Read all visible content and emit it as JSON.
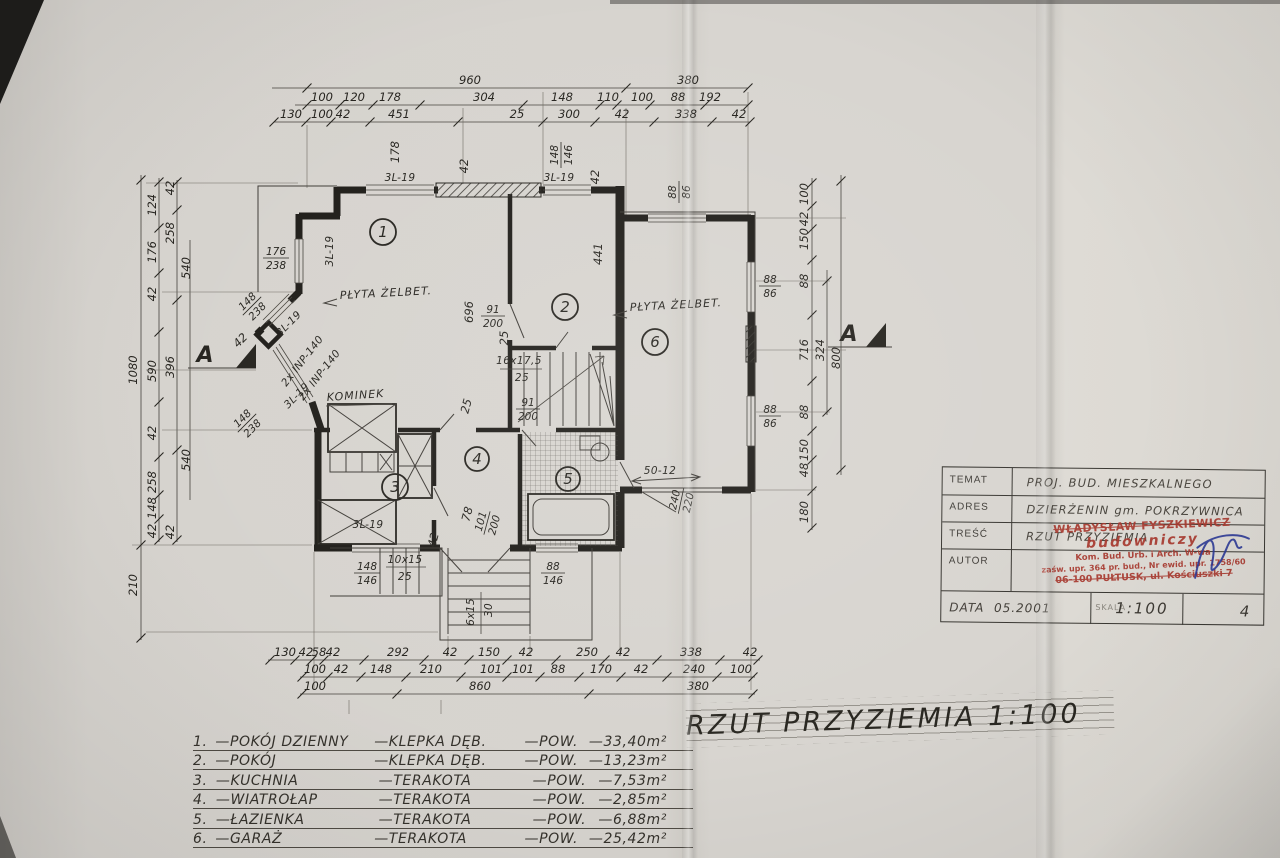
{
  "legend": {
    "dash": "—",
    "pow": "POW.",
    "rows": [
      {
        "no": "1.",
        "name": "POKÓJ DZIENNY",
        "material": "KLEPKA DĘB.",
        "area": "33,40m²"
      },
      {
        "no": "2.",
        "name": "POKÓJ",
        "material": "KLEPKA DĘB.",
        "area": "13,23m²"
      },
      {
        "no": "3.",
        "name": "KUCHNIA",
        "material": "TERAKOTA",
        "area": "7,53m²"
      },
      {
        "no": "4.",
        "name": "WIATROŁAP",
        "material": "TERAKOTA",
        "area": "2,85m²"
      },
      {
        "no": "5.",
        "name": "ŁAZIENKA",
        "material": "TERAKOTA",
        "area": "6,88m²"
      },
      {
        "no": "6.",
        "name": "GARAŻ",
        "material": "TERAKOTA",
        "area": "25,42m²"
      }
    ]
  },
  "title": {
    "text": "RZUT PRZYZIEMIA 1:100"
  },
  "title_block": {
    "labels": {
      "temat": "TEMAT",
      "adres": "ADRES",
      "tresc": "TREŚĆ",
      "autor": "AUTOR",
      "data": "DATA",
      "skala": "SKALA"
    },
    "values": {
      "temat": "PROJ. BUD. MIESZKALNEGO",
      "adres": "DZIERŻENIN gm. POKRZYWNICA",
      "tresc": "RZUT PRZYZIEMIA",
      "data": "05.2001",
      "skala": "1:100",
      "sheet": "4"
    },
    "stamp": {
      "name": "WŁADYSŁAW FYSZKIEWICZ",
      "title": "budowniczy",
      "line1": "Kom. Bud. Urb. i Arch. W-wa",
      "line2": "zaśw. upr. 364 pr. bud., Nr ewid. upr. 1758/60",
      "line3": "06-100 PUŁTUSK, ul. Kościuszki 7"
    }
  },
  "plan": {
    "rooms": [
      "1",
      "2",
      "3",
      "4",
      "5",
      "6"
    ],
    "labels": {
      "plyta": "PŁYTA ŻELBET.",
      "kominek": "KOMINEK",
      "lintel": "3L-19",
      "inp": "2x INP-140",
      "garage_lintel": "50-12",
      "section": "A",
      "stair_main_n": "16x17,5",
      "stair_main_d": "25",
      "stair_terr_n": "10x15",
      "stair_terr_d": "25",
      "stair_entry_n": "6x15",
      "stair_entry_d": "30"
    },
    "pairs": {
      "w176": [
        "176",
        "238"
      ],
      "w148": [
        "148",
        "238"
      ],
      "t148": [
        "148",
        "146"
      ],
      "w88": [
        "88",
        "86"
      ],
      "b88": [
        "88",
        "146"
      ],
      "k148": [
        "148",
        "146"
      ],
      "d91": [
        "91",
        "200"
      ],
      "d101": [
        "101",
        "200"
      ],
      "g240": [
        "240",
        "220"
      ]
    },
    "singles": {
      "d696": "696",
      "d441": "441",
      "d178": "178",
      "d42": "42",
      "d25": "25",
      "d78": "78"
    },
    "chains": {
      "top1": [
        "960",
        "380"
      ],
      "top2": [
        "100",
        "120",
        "178",
        "304",
        "148",
        "110",
        "100",
        "88",
        "192"
      ],
      "top3": [
        "130",
        "100",
        "42",
        "451",
        "25",
        "300",
        "42",
        "338",
        "42"
      ],
      "bot1": [
        "130",
        "42",
        "58",
        "42",
        "292",
        "42",
        "150",
        "42",
        "250",
        "42",
        "338",
        "42"
      ],
      "bot2": [
        "100",
        "42",
        "148",
        "210",
        "101",
        "101",
        "88",
        "170",
        "42",
        "240",
        "100"
      ],
      "bot3": [
        "100",
        "860",
        "380"
      ],
      "left_outer": [
        "1080",
        "210"
      ],
      "left_mid": [
        "124",
        "176",
        "42",
        "590",
        "42",
        "258",
        "148",
        "42"
      ],
      "left_inner": [
        "42",
        "258",
        "396",
        "42"
      ],
      "left_inner2": [
        "540",
        "540"
      ],
      "right_outer": [
        "100",
        "42",
        "150",
        "88",
        "716",
        "88",
        "150",
        "48",
        "180"
      ],
      "right_inner": [
        "324"
      ],
      "right_inner2": [
        "800"
      ]
    }
  }
}
